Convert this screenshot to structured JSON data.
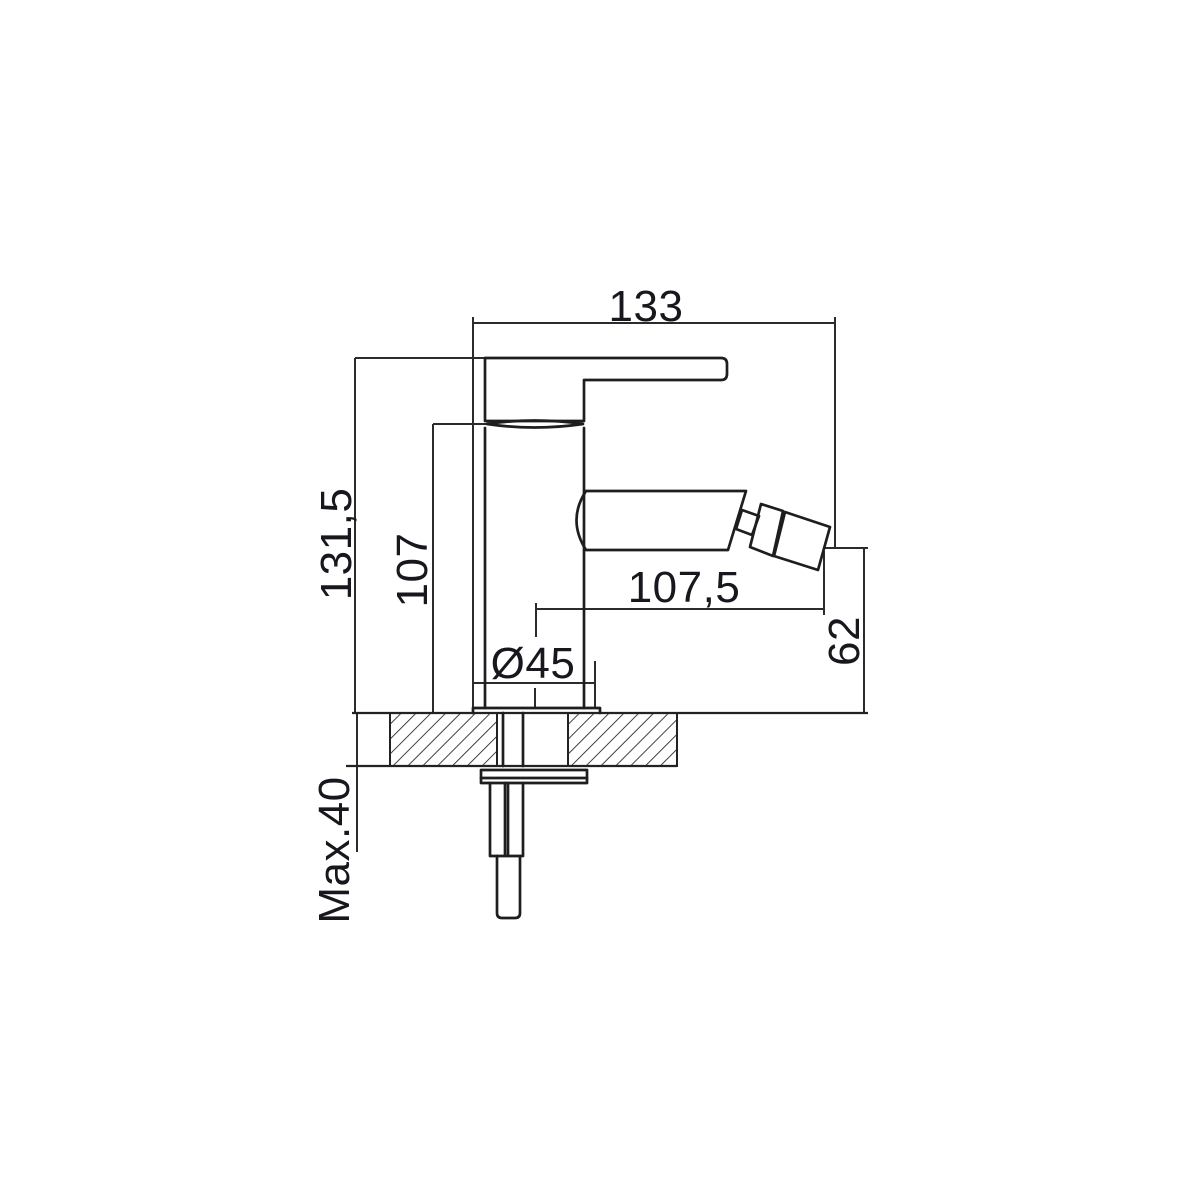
{
  "drawing": {
    "type": "technical-dimension-drawing",
    "subject": "single-lever bidet mixer tap, side elevation with deck mounting section",
    "background_color": "#ffffff",
    "line_color": "#1e1e20",
    "text_color": "#17171e",
    "labels": {
      "overall_length": "133",
      "overall_height": "131,5",
      "body_height": "107",
      "spout_reach": "107,5",
      "base_diameter": "Ø45",
      "outlet_height": "62",
      "max_deck_thickness": "Max.40"
    }
  }
}
